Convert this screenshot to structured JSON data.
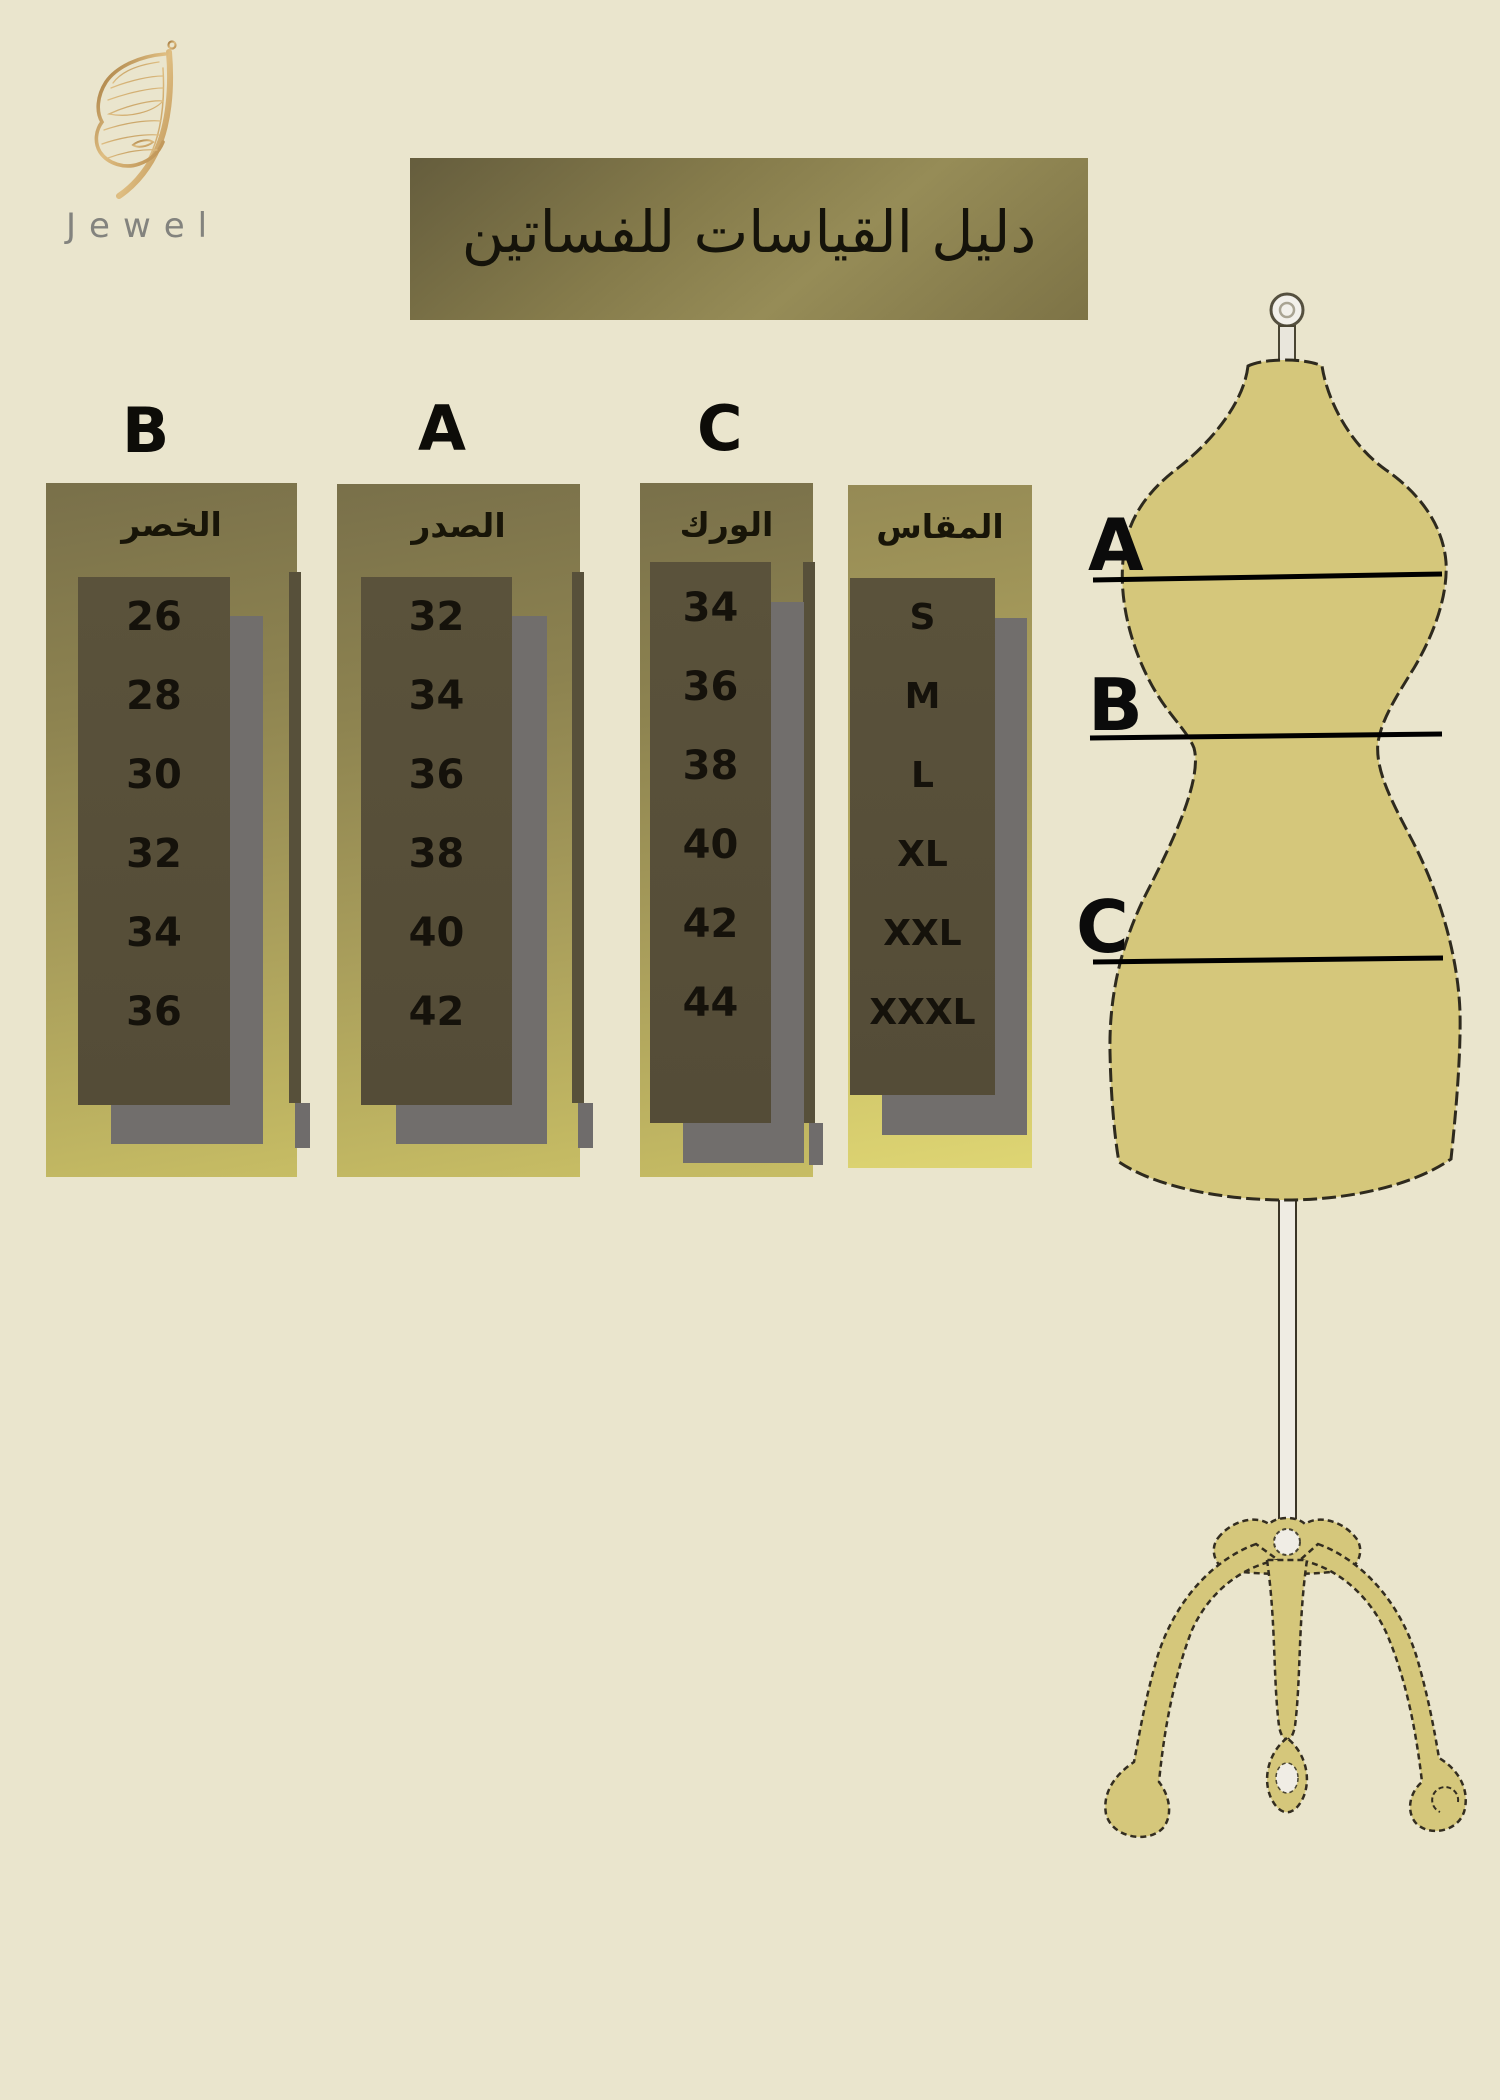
{
  "brand": {
    "name": "Jewel",
    "logo_icon": "butterfly"
  },
  "title": "دليل القياسات للفساتين",
  "tables": [
    {
      "letter": "B",
      "header": "الخصر",
      "values": [
        "26",
        "28",
        "30",
        "32",
        "34",
        "36"
      ]
    },
    {
      "letter": "A",
      "header": "الصدر",
      "values": [
        "32",
        "34",
        "36",
        "38",
        "40",
        "42"
      ]
    },
    {
      "letter": "C",
      "header": "الورك",
      "values": [
        "34",
        "36",
        "38",
        "40",
        "42",
        "44"
      ]
    },
    {
      "letter": "",
      "header": "المقاس",
      "values": [
        "S",
        "M",
        "L",
        "XL",
        "XXL",
        "XXXL"
      ]
    }
  ],
  "mannequin": {
    "labels": [
      "A",
      "B",
      "C"
    ],
    "label_meaning": {
      "A": "bust line",
      "B": "waist line",
      "C": "hip line"
    }
  },
  "colors": {
    "background": "#eae5cd",
    "panel_olive_top": "#79704a",
    "panel_olive_bottom": "#c7bd64",
    "size_panel_bottom": "#ded573",
    "dark_box": "#57503a",
    "shadow_gray": "#716e6c",
    "banner_olive": "#857b4b",
    "mannequin_body": "#d5c77b",
    "logo_gold": "#c49a55",
    "brand_text_gray": "#83837e",
    "text_black": "#15120b"
  }
}
